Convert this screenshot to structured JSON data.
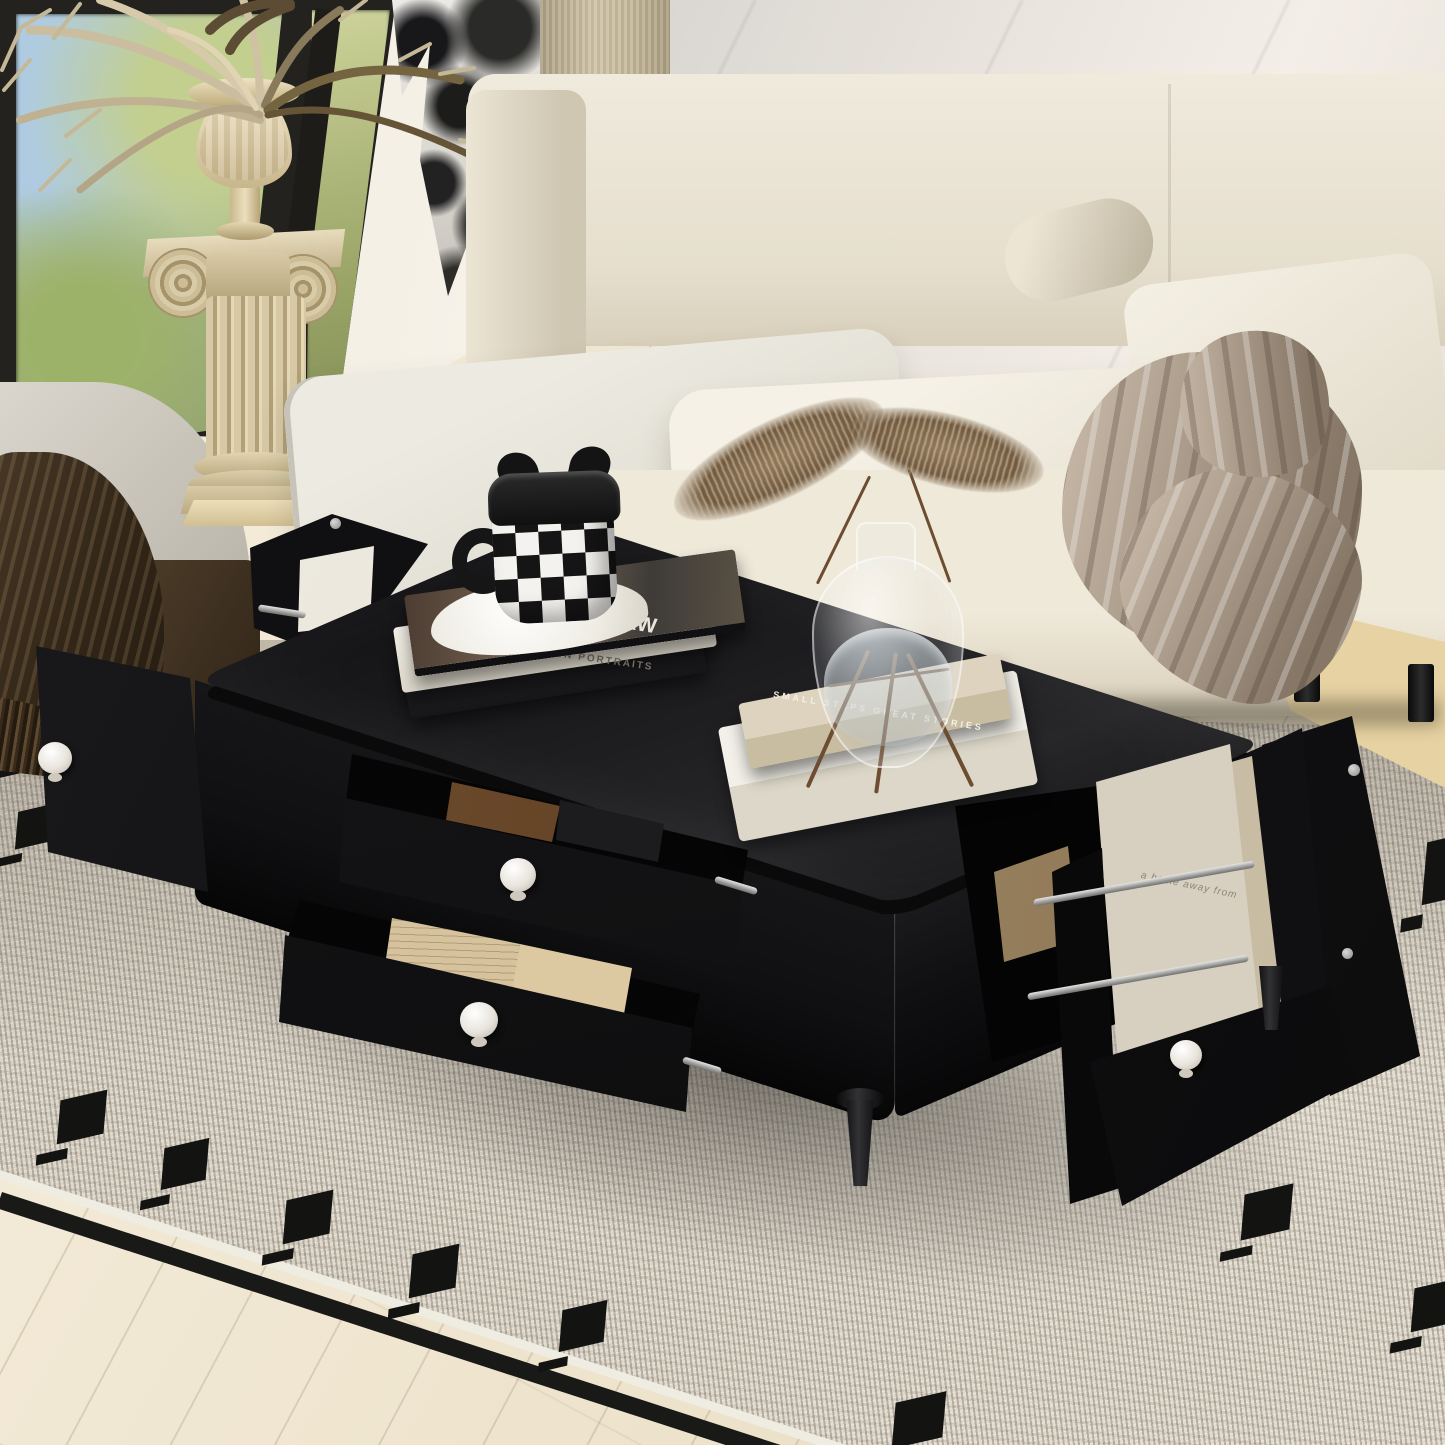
{
  "scene": {
    "type": "product lifestyle photograph",
    "setting": "modern living room with marble wall, window, cream sofa and speckled rug",
    "subject": "black rectangular coffee table with two pulled-out storage drawers and two swing-open side doors fitted with magazine racks"
  },
  "palette": {
    "table_black": "#141416",
    "knob_white": "#f2efe9",
    "sofa_cream": "#efe9da",
    "rug_speckle": "#d6cfc2",
    "rug_motif_black": "#131311",
    "floor_wood": "#efe5cf",
    "marble": "#e9e4dd",
    "column_beige": "#d8c9a6",
    "throw_taupe": "#a6968 5",
    "throw_brown": "#332718"
  },
  "objects": {
    "table": {
      "name": "black coffee table",
      "features": [
        "two open drawers with round white knobs",
        "left door open showing outer panel",
        "right door open with built-in magazine rack and steel rods",
        "rear rack door with papers",
        "turned black legs"
      ]
    },
    "books_left": {
      "top_title": "WROCŁAW",
      "top_subtitle": "Be prepared | Wrocław · welcome to Polish diamond",
      "middle_title": "CARL BENGTSSON  PORTRAITS"
    },
    "books_right": {
      "spine_title": "SMALL STEPS GREAT STORIES"
    },
    "magazine": {
      "cover_text": "a home away from"
    },
    "mug": {
      "style": "black and white checkerboard mug with cat-ear lid on white scalloped saucer"
    },
    "vase": {
      "style": "clear glass bulb vase with water on wooden stand holding two dried pampas stems"
    },
    "drawer_top_contents": "brown leather watch strap",
    "drawer_bottom_contents": "kraft envelopes with handwriting",
    "sofa": {
      "style": "cream fabric sofa with two linen back pillows, bolster and taupe silk throw"
    },
    "rug": {
      "style": "grey speckled rug with black border stripe and black square-dash motifs"
    },
    "column": {
      "style": "ionic plaster column with urn of dried palm fronds"
    }
  }
}
